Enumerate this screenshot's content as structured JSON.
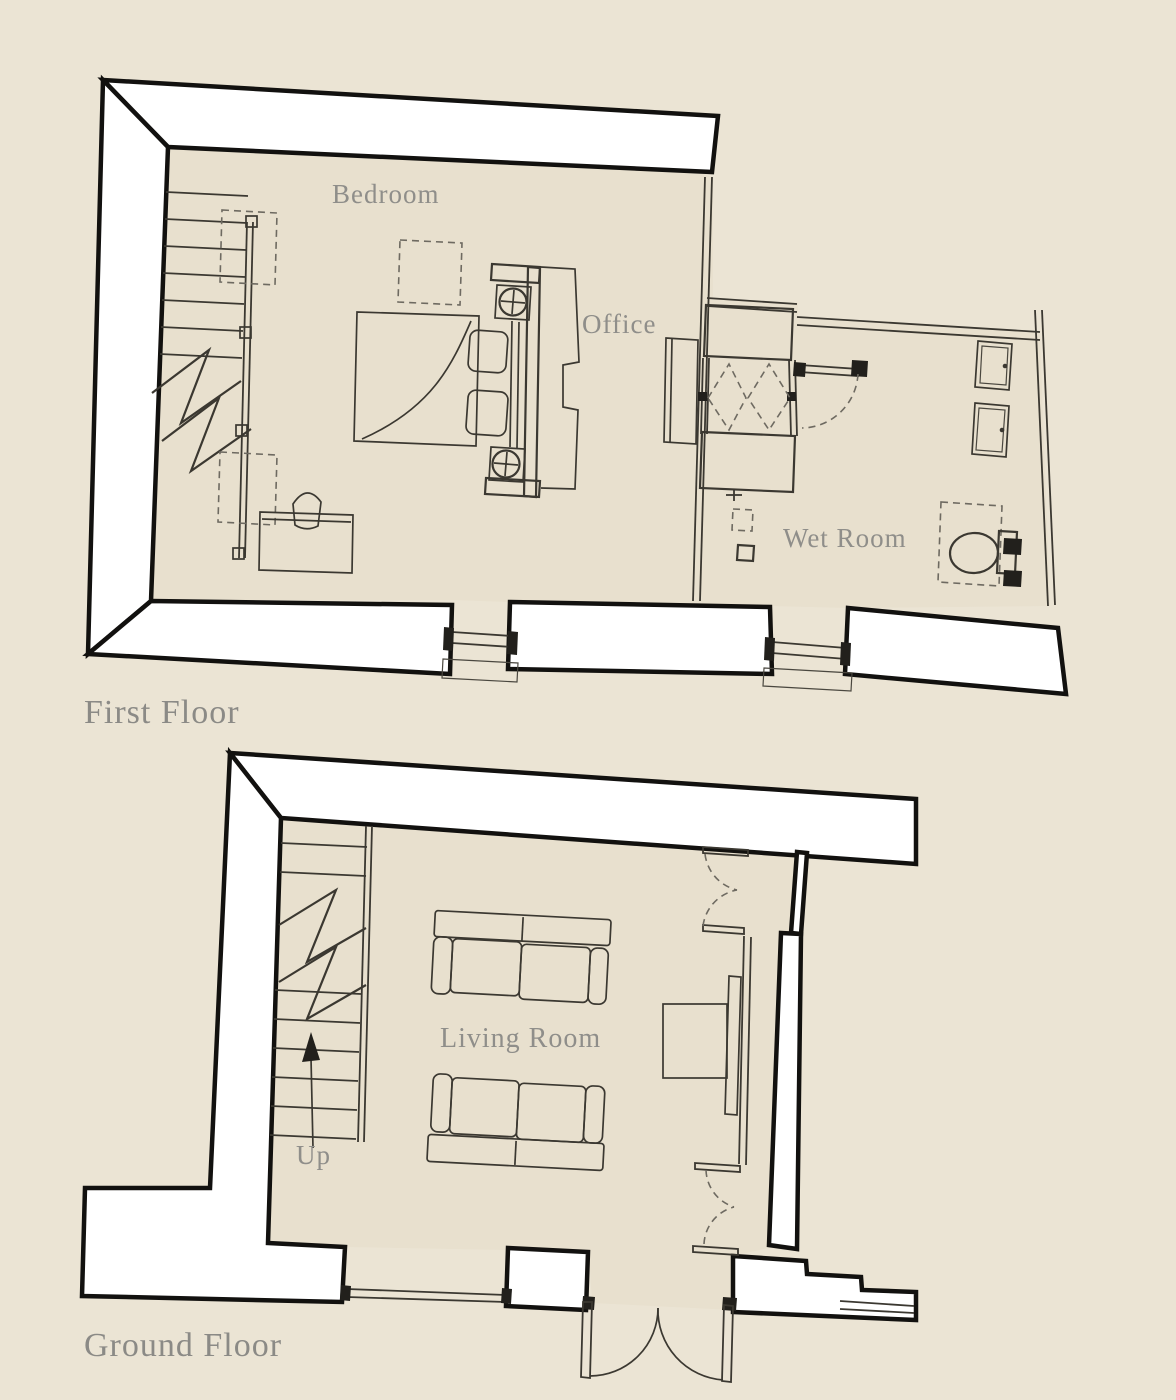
{
  "document_type": "estate-agent floor plan drawing",
  "colors": {
    "page_background": "#ebe4d4",
    "interior_floor": "#e8e0ce",
    "wall_fill": "#ffffff",
    "wall_stroke": "#12110f",
    "thin_line": "#3b3831",
    "label_text": "#8f8e8a"
  },
  "plan": {
    "first_floor": {
      "title": "First Floor",
      "rooms": {
        "bedroom": "Bedroom",
        "office": "Office",
        "wet_room": "Wet Room"
      }
    },
    "ground_floor": {
      "title": "Ground Floor",
      "rooms": {
        "living_room": "Living Room"
      },
      "stairs_direction": "Up"
    }
  }
}
